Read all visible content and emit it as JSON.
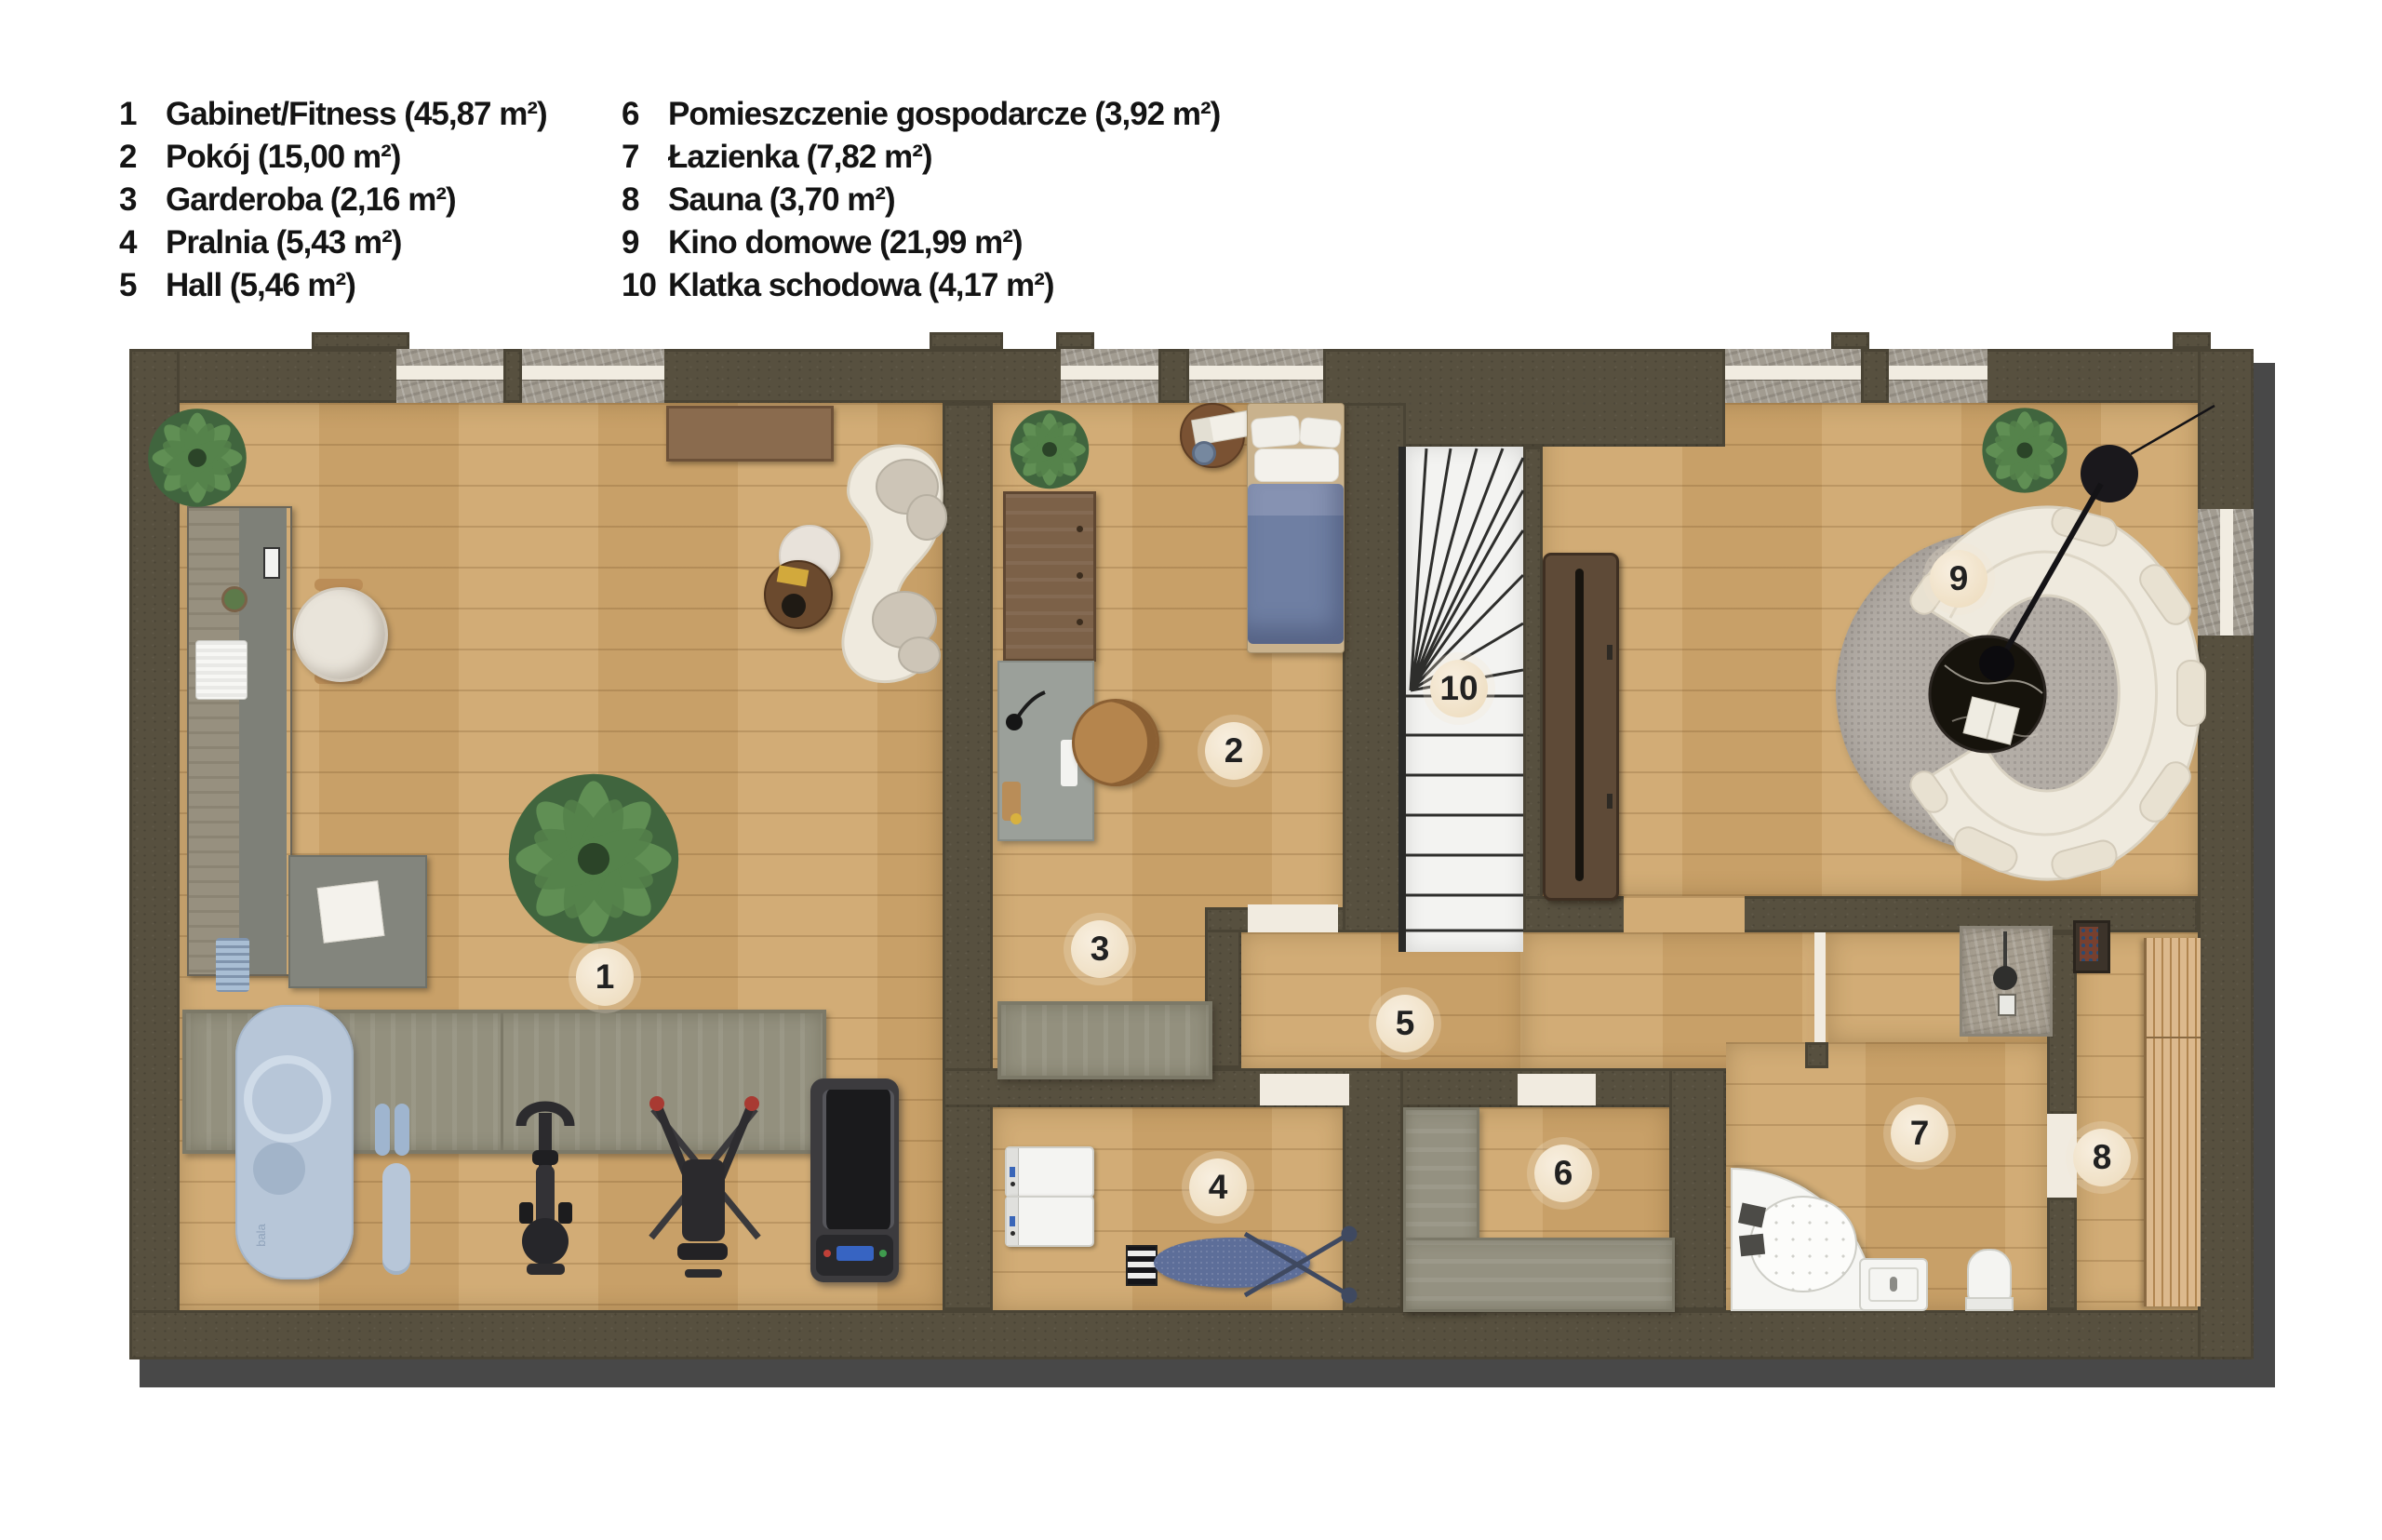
{
  "legend": {
    "col1": [
      {
        "num": "1",
        "label": "Gabinet/Fitness (45,87 m²)"
      },
      {
        "num": "2",
        "label": "Pokój (15,00 m²)"
      },
      {
        "num": "3",
        "label": "Garderoba (2,16 m²)"
      },
      {
        "num": "4",
        "label": "Pralnia (5,43 m²)"
      },
      {
        "num": "5",
        "label": "Hall (5,46 m²)"
      }
    ],
    "col2": [
      {
        "num": "6",
        "label": "Pomieszczenie gospodarcze (3,92 m²)"
      },
      {
        "num": "7",
        "label": "Łazienka (7,82 m²)"
      },
      {
        "num": "8",
        "label": "Sauna (3,70 m²)"
      },
      {
        "num": "9",
        "label": "Kino domowe (21,99 m²)"
      },
      {
        "num": "10",
        "label": "Klatka schodowa (4,17 m²)"
      }
    ]
  },
  "badges": [
    "1",
    "2",
    "3",
    "4",
    "5",
    "6",
    "7",
    "8",
    "9",
    "10"
  ],
  "mat_brand": "bala",
  "colors": {
    "wall": "#57503f",
    "floor": "#cfa76e",
    "stairs": "#f3f3f1",
    "bed_duvet": "#6f7fa3",
    "rug": "#b3ada6",
    "badge": "#f3e7d2",
    "shadow": "#484848"
  }
}
